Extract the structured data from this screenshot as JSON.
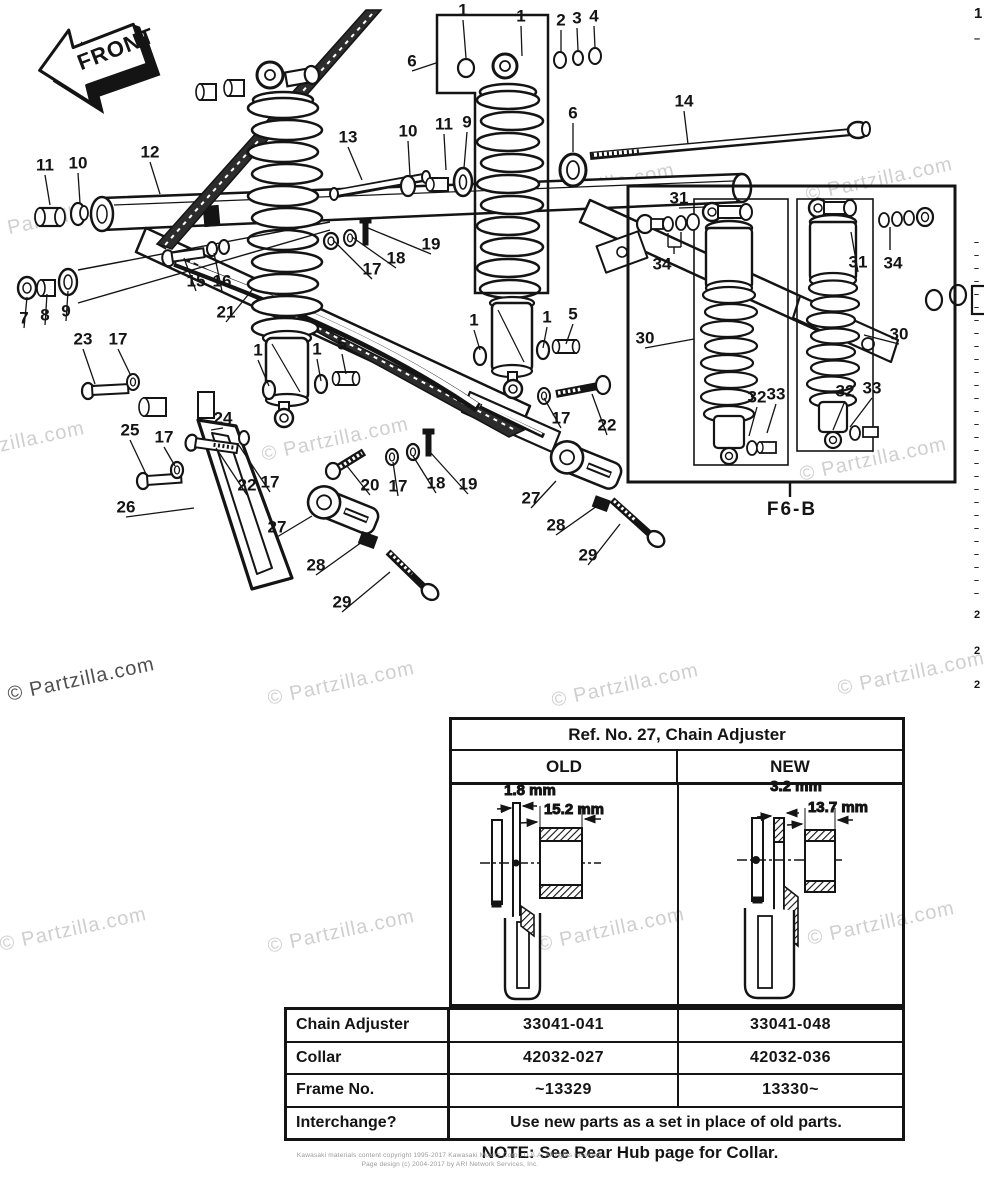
{
  "front_arrow": {
    "label": "FRONT"
  },
  "inset": {
    "label": "F6-B"
  },
  "watermarks": {
    "text": "© Partzilla.com",
    "items": [
      {
        "x": -8,
        "y": -24,
        "dark": false
      },
      {
        "x": 250,
        "y": -26,
        "dark": false
      },
      {
        "x": -14,
        "y": 222,
        "dark": false
      },
      {
        "x": 528,
        "y": 190,
        "dark": false
      },
      {
        "x": 806,
        "y": 184,
        "dark": false
      },
      {
        "x": -62,
        "y": 448,
        "dark": false
      },
      {
        "x": 262,
        "y": 444,
        "dark": false
      },
      {
        "x": 800,
        "y": 464,
        "dark": false
      },
      {
        "x": 8,
        "y": 684,
        "dark": true
      },
      {
        "x": 268,
        "y": 688,
        "dark": false
      },
      {
        "x": 552,
        "y": 690,
        "dark": false
      },
      {
        "x": 838,
        "y": 678,
        "dark": false
      },
      {
        "x": 0,
        "y": 934,
        "dark": false
      },
      {
        "x": 268,
        "y": 936,
        "dark": false
      },
      {
        "x": 538,
        "y": 934,
        "dark": false
      },
      {
        "x": 808,
        "y": 928,
        "dark": false
      }
    ]
  },
  "callouts": [
    {
      "n": "11",
      "x": 45,
      "y": 166,
      "tx": 50,
      "ty": 205
    },
    {
      "n": "10",
      "x": 78,
      "y": 164,
      "tx": 80,
      "ty": 203
    },
    {
      "n": "12",
      "x": 150,
      "y": 153,
      "tx": 160,
      "ty": 194
    },
    {
      "n": "13",
      "x": 348,
      "y": 138,
      "tx": 362,
      "ty": 180
    },
    {
      "n": "10",
      "x": 408,
      "y": 132,
      "tx": 410,
      "ty": 176
    },
    {
      "n": "11",
      "x": 444,
      "y": 125,
      "tx": 446,
      "ty": 170
    },
    {
      "n": "9",
      "x": 467,
      "y": 123,
      "tx": 464,
      "ty": 168
    },
    {
      "n": "6",
      "x": 412,
      "y": 62,
      "tx": 436,
      "ty": 63
    },
    {
      "n": "1",
      "x": 463,
      "y": 11,
      "tx": 466,
      "ty": 58
    },
    {
      "n": "1",
      "x": 521,
      "y": 17,
      "tx": 522,
      "ty": 56
    },
    {
      "n": "2",
      "x": 561,
      "y": 21,
      "tx": 561,
      "ty": 52
    },
    {
      "n": "3",
      "x": 577,
      "y": 19,
      "tx": 578,
      "ty": 50
    },
    {
      "n": "4",
      "x": 594,
      "y": 17,
      "tx": 595,
      "ty": 48
    },
    {
      "n": "6",
      "x": 573,
      "y": 114,
      "tx": 573,
      "ty": 152
    },
    {
      "n": "14",
      "x": 684,
      "y": 102,
      "tx": 688,
      "ty": 144
    },
    {
      "n": "19",
      "x": 431,
      "y": 245,
      "tx": 368,
      "ty": 228
    },
    {
      "n": "18",
      "x": 396,
      "y": 259,
      "tx": 352,
      "ty": 237
    },
    {
      "n": "17",
      "x": 372,
      "y": 270,
      "tx": 333,
      "ty": 240
    },
    {
      "n": "15",
      "x": 196,
      "y": 282,
      "tx": 184,
      "ty": 258
    },
    {
      "n": "16",
      "x": 222,
      "y": 282,
      "tx": 214,
      "ty": 253
    },
    {
      "n": "21",
      "x": 226,
      "y": 313,
      "tx": 252,
      "ty": 290
    },
    {
      "n": "7",
      "x": 24,
      "y": 319,
      "tx": 27,
      "ty": 297
    },
    {
      "n": "8",
      "x": 45,
      "y": 316,
      "tx": 47,
      "ty": 294
    },
    {
      "n": "9",
      "x": 66,
      "y": 312,
      "tx": 68,
      "ty": 291
    },
    {
      "n": "23",
      "x": 83,
      "y": 340,
      "tx": 95,
      "ty": 384
    },
    {
      "n": "17",
      "x": 118,
      "y": 340,
      "tx": 131,
      "ty": 376
    },
    {
      "n": "25",
      "x": 130,
      "y": 431,
      "tx": 146,
      "ty": 474
    },
    {
      "n": "17",
      "x": 164,
      "y": 438,
      "tx": 175,
      "ty": 466
    },
    {
      "n": "26",
      "x": 126,
      "y": 508,
      "tx": 194,
      "ty": 508
    },
    {
      "n": "24",
      "x": 223,
      "y": 419,
      "tx": 211,
      "ty": 430
    },
    {
      "n": "22",
      "x": 247,
      "y": 486,
      "tx": 216,
      "ty": 448
    },
    {
      "n": "17",
      "x": 270,
      "y": 483,
      "tx": 238,
      "ty": 444
    },
    {
      "n": "27",
      "x": 277,
      "y": 528,
      "tx": 312,
      "ty": 516
    },
    {
      "n": "28",
      "x": 316,
      "y": 566,
      "tx": 362,
      "ty": 542
    },
    {
      "n": "29",
      "x": 342,
      "y": 603,
      "tx": 390,
      "ty": 572
    },
    {
      "n": "20",
      "x": 370,
      "y": 486,
      "tx": 347,
      "ty": 466
    },
    {
      "n": "17",
      "x": 398,
      "y": 487,
      "tx": 393,
      "ty": 462
    },
    {
      "n": "18",
      "x": 436,
      "y": 484,
      "tx": 413,
      "ty": 456
    },
    {
      "n": "19",
      "x": 468,
      "y": 485,
      "tx": 430,
      "ty": 452
    },
    {
      "n": "1",
      "x": 258,
      "y": 351,
      "tx": 269,
      "ty": 386
    },
    {
      "n": "1",
      "x": 317,
      "y": 350,
      "tx": 321,
      "ty": 381
    },
    {
      "n": "5",
      "x": 342,
      "y": 345,
      "tx": 346,
      "ty": 374
    },
    {
      "n": "1",
      "x": 474,
      "y": 321,
      "tx": 480,
      "ty": 350
    },
    {
      "n": "1",
      "x": 547,
      "y": 318,
      "tx": 543,
      "ty": 348
    },
    {
      "n": "5",
      "x": 573,
      "y": 315,
      "tx": 566,
      "ty": 344
    },
    {
      "n": "17",
      "x": 561,
      "y": 419,
      "tx": 544,
      "ty": 398
    },
    {
      "n": "22",
      "x": 607,
      "y": 426,
      "tx": 592,
      "ty": 394
    },
    {
      "n": "27",
      "x": 531,
      "y": 499,
      "tx": 556,
      "ty": 481
    },
    {
      "n": "28",
      "x": 556,
      "y": 526,
      "tx": 597,
      "ty": 506
    },
    {
      "n": "29",
      "x": 588,
      "y": 556,
      "tx": 620,
      "ty": 524
    },
    {
      "n": "31",
      "x": 679,
      "y": 199,
      "tx": 706,
      "ty": 207
    },
    {
      "n": "34",
      "x": 662,
      "y": 265
    },
    {
      "n": "30",
      "x": 645,
      "y": 339,
      "tx": 694,
      "ty": 339
    },
    {
      "n": "32",
      "x": 757,
      "y": 398,
      "tx": 749,
      "ty": 436
    },
    {
      "n": "33",
      "x": 776,
      "y": 395,
      "tx": 767,
      "ty": 433
    },
    {
      "n": "31",
      "x": 858,
      "y": 263,
      "tx": 851,
      "ty": 232
    },
    {
      "n": "34",
      "x": 893,
      "y": 264
    },
    {
      "n": "30",
      "x": 899,
      "y": 335,
      "tx": 864,
      "ty": 335
    },
    {
      "n": "32",
      "x": 845,
      "y": 392,
      "tx": 833,
      "ty": 430
    },
    {
      "n": "33",
      "x": 872,
      "y": 389,
      "tx": 850,
      "ty": 427
    }
  ],
  "table": {
    "title": "Ref. No. 27, Chain Adjuster",
    "columns": [
      "OLD",
      "NEW"
    ],
    "old_dims": {
      "thickness": "1.8 mm",
      "width": "15.2 mm"
    },
    "new_dims": {
      "thickness": "3.2 mm",
      "width": "13.7 mm"
    },
    "rows": [
      {
        "label": "Chain Adjuster",
        "old": "33041-041",
        "new": "33041-048"
      },
      {
        "label": "Collar",
        "old": "42032-027",
        "new": "42032-036"
      },
      {
        "label": "Frame No.",
        "old": "~13329",
        "new": "13330~"
      },
      {
        "label": "Interchange?",
        "span": "Use new parts as a set in place of old parts."
      }
    ],
    "note": "NOTE: See Rear Hub page for Collar."
  },
  "footer": {
    "line1": "Kawasaki materials content copyright 1995-2017 Kawasaki Motors Corp., U.S.A. All rights reserved.",
    "line2": "Page design (c) 2004-2017 by ARI Network Services, Inc."
  },
  "right_edge": {
    "marks": [
      {
        "ch": "1",
        "y": 6,
        "s": 15
      },
      {
        "ch": "–",
        "y": 34,
        "s": 11
      },
      {
        "ch": "2",
        "y": 610,
        "s": 11
      },
      {
        "ch": "2",
        "y": 646,
        "s": 11
      },
      {
        "ch": "2",
        "y": 680,
        "s": 11
      }
    ],
    "ticks": {
      "from": 238,
      "to": 598,
      "step": 13,
      "ch": "–",
      "s": 9
    }
  }
}
